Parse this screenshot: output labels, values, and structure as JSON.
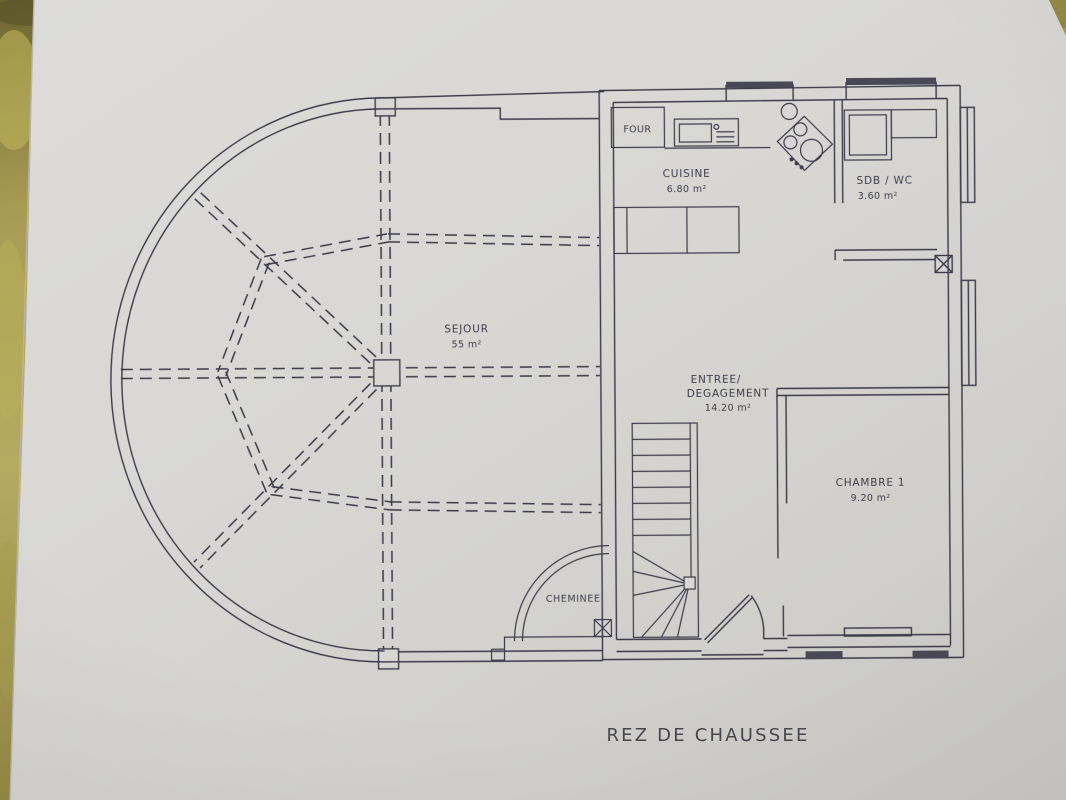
{
  "document": {
    "type": "architectural-floor-plan-photo",
    "title": "REZ DE CHAUSSEE",
    "colors": {
      "ink": "#3b3b49",
      "paper": "#d8d7d4",
      "backdrop_olive": "#9a8f47"
    }
  },
  "rooms": {
    "cuisine": {
      "name": "CUISINE",
      "area": "6.80 m²"
    },
    "sdb": {
      "name": "SDB  / WC",
      "area": "3.60 m²"
    },
    "sejour": {
      "name": "SEJOUR",
      "area": "55 m²"
    },
    "entree": {
      "line1": "ENTREE/",
      "line2": "DEGAGEMENT",
      "area": "14.20 m²"
    },
    "chambre": {
      "name": "CHAMBRE 1",
      "area": "9.20 m²"
    }
  },
  "fixtures": {
    "four": "FOUR",
    "cheminee": "CHEMINEE"
  }
}
